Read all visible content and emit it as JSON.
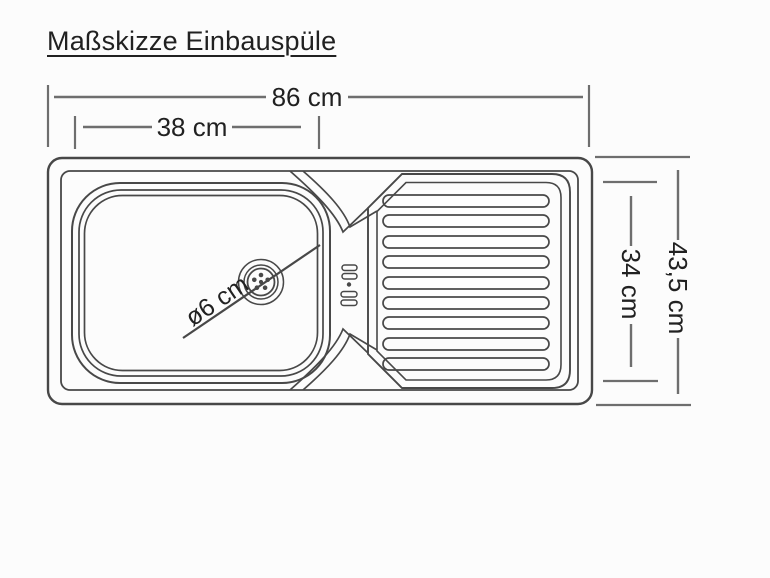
{
  "title": "Maßskizze Einbauspüle",
  "dims": {
    "total_width": "86 cm",
    "basin_width": "38 cm",
    "total_depth": "43,5 cm",
    "inner_depth": "34 cm",
    "drain_diameter": "ø6 cm"
  },
  "colors": {
    "bg": "#fcfcfc",
    "line": "#484848",
    "dim": "#6e6e6e",
    "text": "#212121"
  }
}
